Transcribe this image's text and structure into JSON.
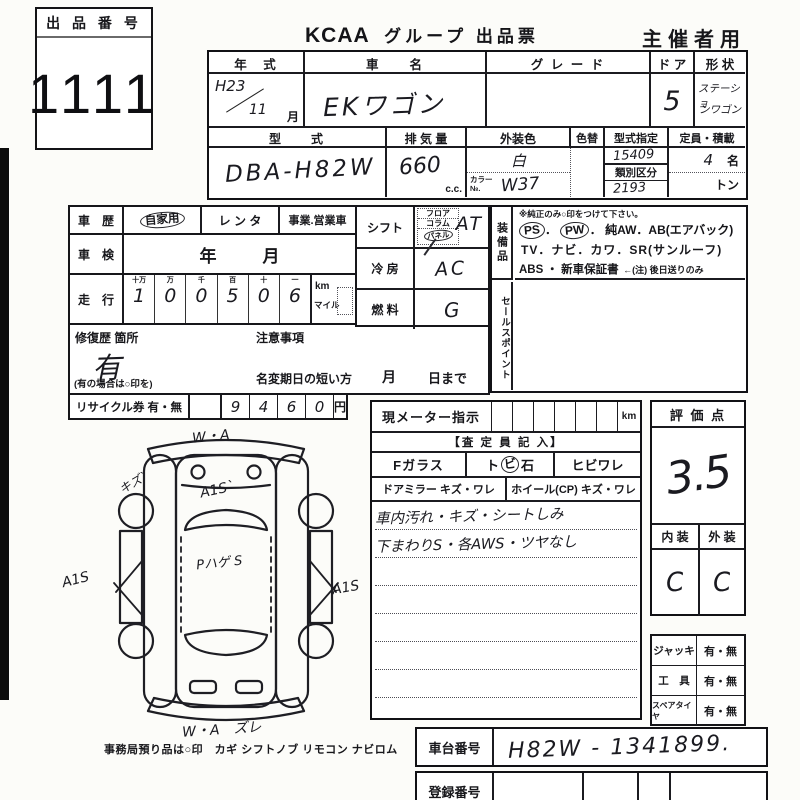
{
  "lot": {
    "label": "出 品 番 号",
    "number": "1111"
  },
  "header": {
    "brand": "KCAA",
    "title": "グループ 出品票",
    "right": "主催者用"
  },
  "top_table": {
    "year_header": "年　式",
    "year_era": "H23",
    "year_month": "11",
    "month_suffix": "月",
    "name_header": "車　　名",
    "name_value": "EKワゴン",
    "grade_header": "グ レ ー ド",
    "grade_value": "",
    "door_header": "ド ア",
    "door_value": "5",
    "shape_header": "形 状",
    "shape_line1": "ステーショ",
    "shape_line2": "ンワゴン",
    "model_header": "型　　式",
    "model_value": "DBA-H82W",
    "disp_header": "排 気 量",
    "disp_value": "660",
    "disp_unit": "c.c.",
    "color_header": "外装色",
    "color_value": "白",
    "color_no_label1": "カラー",
    "color_no_label2": "№.",
    "color_no_value": "W37",
    "recolor_header": "色替",
    "type_desig_header": "型式指定",
    "type_desig_value": "15409",
    "class_header": "類別区分",
    "class_value": "2193",
    "capacity_header": "定員・積載",
    "capacity_value": "4",
    "capacity_unit": "名",
    "load_unit": "トン"
  },
  "history": {
    "label": "車　歴",
    "opt1": "自家用",
    "opt2": "レ ン タ",
    "opt3": "事業.営業車"
  },
  "shaken": {
    "label": "車　検",
    "year": "年",
    "month": "月"
  },
  "mileage": {
    "label": "走　行",
    "digit_headers": [
      "十万",
      "万",
      "千",
      "百",
      "十",
      "一"
    ],
    "digits": [
      "1",
      "0",
      "0",
      "5",
      "0",
      "6"
    ],
    "unit_km": "km",
    "unit_mile": "マイル"
  },
  "repair": {
    "label": "修復歴 箇所",
    "value": "有",
    "note": "(有の場合は○印を)"
  },
  "caution": {
    "label": "注意事項",
    "transfer_label": "名変期日の短い方",
    "month": "月",
    "day_suffix": "日まで"
  },
  "recycle": {
    "label": "リサイクル券 有・無",
    "digits": [
      "9",
      "4",
      "6",
      "0"
    ],
    "unit": "円"
  },
  "shift": {
    "label": "シフト",
    "opt1": "フロア",
    "opt2": "コラム",
    "opt3": "パネル",
    "value": "AT"
  },
  "aircon": {
    "label": "冷 房",
    "value": "AC"
  },
  "fuel": {
    "label": "燃 料",
    "value": "G"
  },
  "equipment": {
    "label": "装備品",
    "note": "※純正のみ○印をつけて下さい。",
    "ps": "PS",
    "pw": "PW",
    "line1_rest": "純AW．AB(エアバック)",
    "line2": "TV．ナビ．カワ．SR(サンルーフ)",
    "line3": "ABS ・ 新車保証書",
    "line3_note": "←(注) 後日送りのみ"
  },
  "sales_point": {
    "label": "セールスポイント"
  },
  "meter": {
    "label": "現メーター指示",
    "unit": "km",
    "assessor_header": "【査 定 員 記 入】",
    "glass_label": "Fガラス",
    "stone_pre": "ト",
    "stone_mid": "ビ",
    "stone_post": "石",
    "crack_label": "ヒビワレ",
    "mirror_label": "ドアミラー キズ・ワレ",
    "wheel_label": "ホイール(CP) キズ・ワレ",
    "notes": [
      "車内汚れ・キズ・シートしみ",
      "下まわりS・各AWS・ツヤなし"
    ]
  },
  "score": {
    "label": "評 価 点",
    "value": "3.5",
    "interior_label": "内 装",
    "exterior_label": "外 装",
    "interior": "C",
    "exterior": "C"
  },
  "accessories": {
    "rows": [
      {
        "label": "ジャッキ",
        "value": "有・無"
      },
      {
        "label": "工　具",
        "value": "有・無"
      },
      {
        "label": "スペアタイヤ",
        "value": "有・無"
      }
    ]
  },
  "office_note": "事務局預り品は○印　カギ シフトノブ リモコン ナビロム",
  "chassis": {
    "label": "車台番号",
    "value": "H82W - 1341899."
  },
  "registration": {
    "label": "登録番号"
  },
  "diagram": {
    "annotations": [
      {
        "text": "W・A"
      },
      {
        "text": "キズ`"
      },
      {
        "text": "A1S`"
      },
      {
        "text": "Pハゲ S"
      },
      {
        "text": "A1S"
      },
      {
        "text": "A1S"
      },
      {
        "text": "W・A　ズレ"
      }
    ]
  }
}
